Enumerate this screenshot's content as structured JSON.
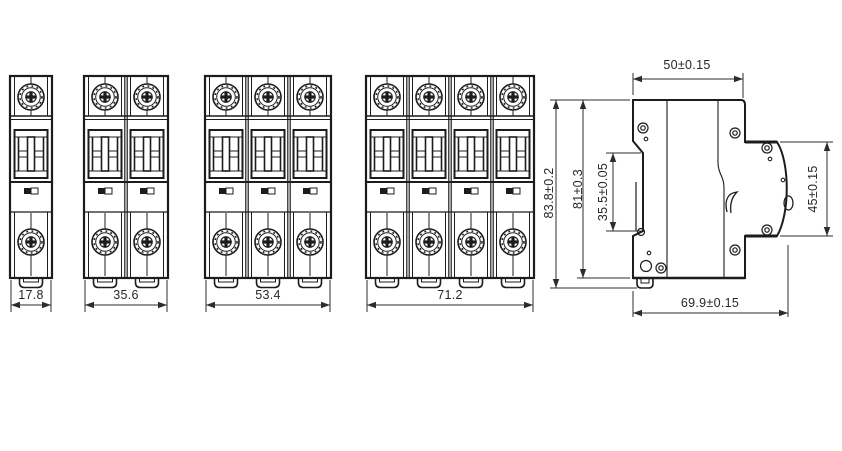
{
  "drawing": {
    "kind": "circuit-breaker outline drawing",
    "colors": {
      "line": "#1c1c1c",
      "dim_line": "#2c2c2c",
      "text": "#272727",
      "background": "#ffffff"
    }
  },
  "front_views": [
    {
      "name": "1-pole breaker",
      "poles": 1,
      "width": "17.8"
    },
    {
      "name": "2-pole breaker",
      "poles": 2,
      "width": "35.6"
    },
    {
      "name": "3-pole breaker",
      "poles": 3,
      "width": "53.4"
    },
    {
      "name": "4-pole breaker",
      "poles": 4,
      "width": "71.2"
    }
  ],
  "side_view": {
    "name": "side profile",
    "top_width": "50±0.15",
    "overall_depth": "69.9±0.15",
    "overall_height": "83.8±0.2",
    "body_height": "81±0.3",
    "din_recess_height": "35.5±0.05",
    "front_height": "45±0.15"
  }
}
